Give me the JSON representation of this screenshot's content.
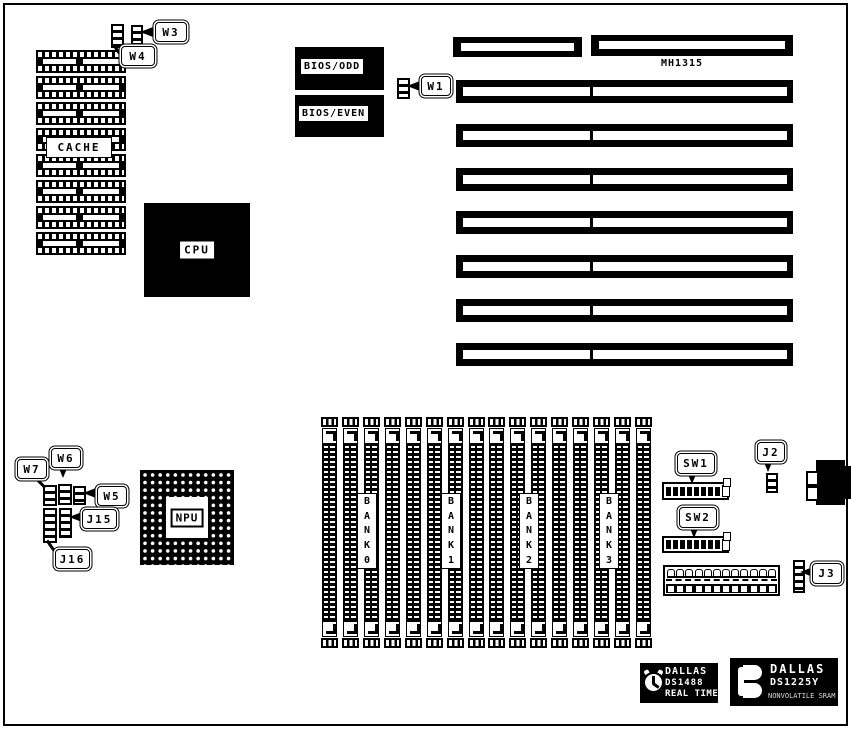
{
  "colors": {
    "ink": "#000000",
    "paper": "#ffffff"
  },
  "callouts": {
    "w1": "W1",
    "w3": "W3",
    "w4": "W4",
    "w5": "W5",
    "w6": "W6",
    "w7": "W7",
    "j2": "J2",
    "j3": "J3",
    "j15": "J15",
    "j16": "J16",
    "sw1": "SW1",
    "sw2": "SW2"
  },
  "chips": {
    "cache_label": "CACHE",
    "cpu_label": "CPU",
    "npu_label": "NPU",
    "bios_odd_label": "BIOS/ODD",
    "bios_even_label": "BIOS/EVEN",
    "board_part_number": "MH1315"
  },
  "cache": {
    "chip_count": 8
  },
  "slots": {
    "count": 8
  },
  "memory": {
    "socket_count": 16,
    "banks": [
      {
        "label": "BANK 0",
        "letters": [
          "B",
          "A",
          "N",
          "K",
          "0"
        ]
      },
      {
        "label": "BANK 1",
        "letters": [
          "B",
          "A",
          "N",
          "K",
          "1"
        ]
      },
      {
        "label": "BANK 2",
        "letters": [
          "B",
          "A",
          "N",
          "K",
          "2"
        ]
      },
      {
        "label": "BANK 3",
        "letters": [
          "B",
          "A",
          "N",
          "K",
          "3"
        ]
      }
    ]
  },
  "dip_switches": {
    "positions_dark": 8,
    "positions_light": 1
  },
  "power_connector": {
    "pin_count": 12
  },
  "dallas_rtc": {
    "line1": "DALLAS",
    "line2": "DS1488",
    "line3": "REAL TIME"
  },
  "dallas_nvram": {
    "line1": "DALLAS",
    "line2": "DS1225Y",
    "line3": "NONVOLATILE SRAM"
  }
}
